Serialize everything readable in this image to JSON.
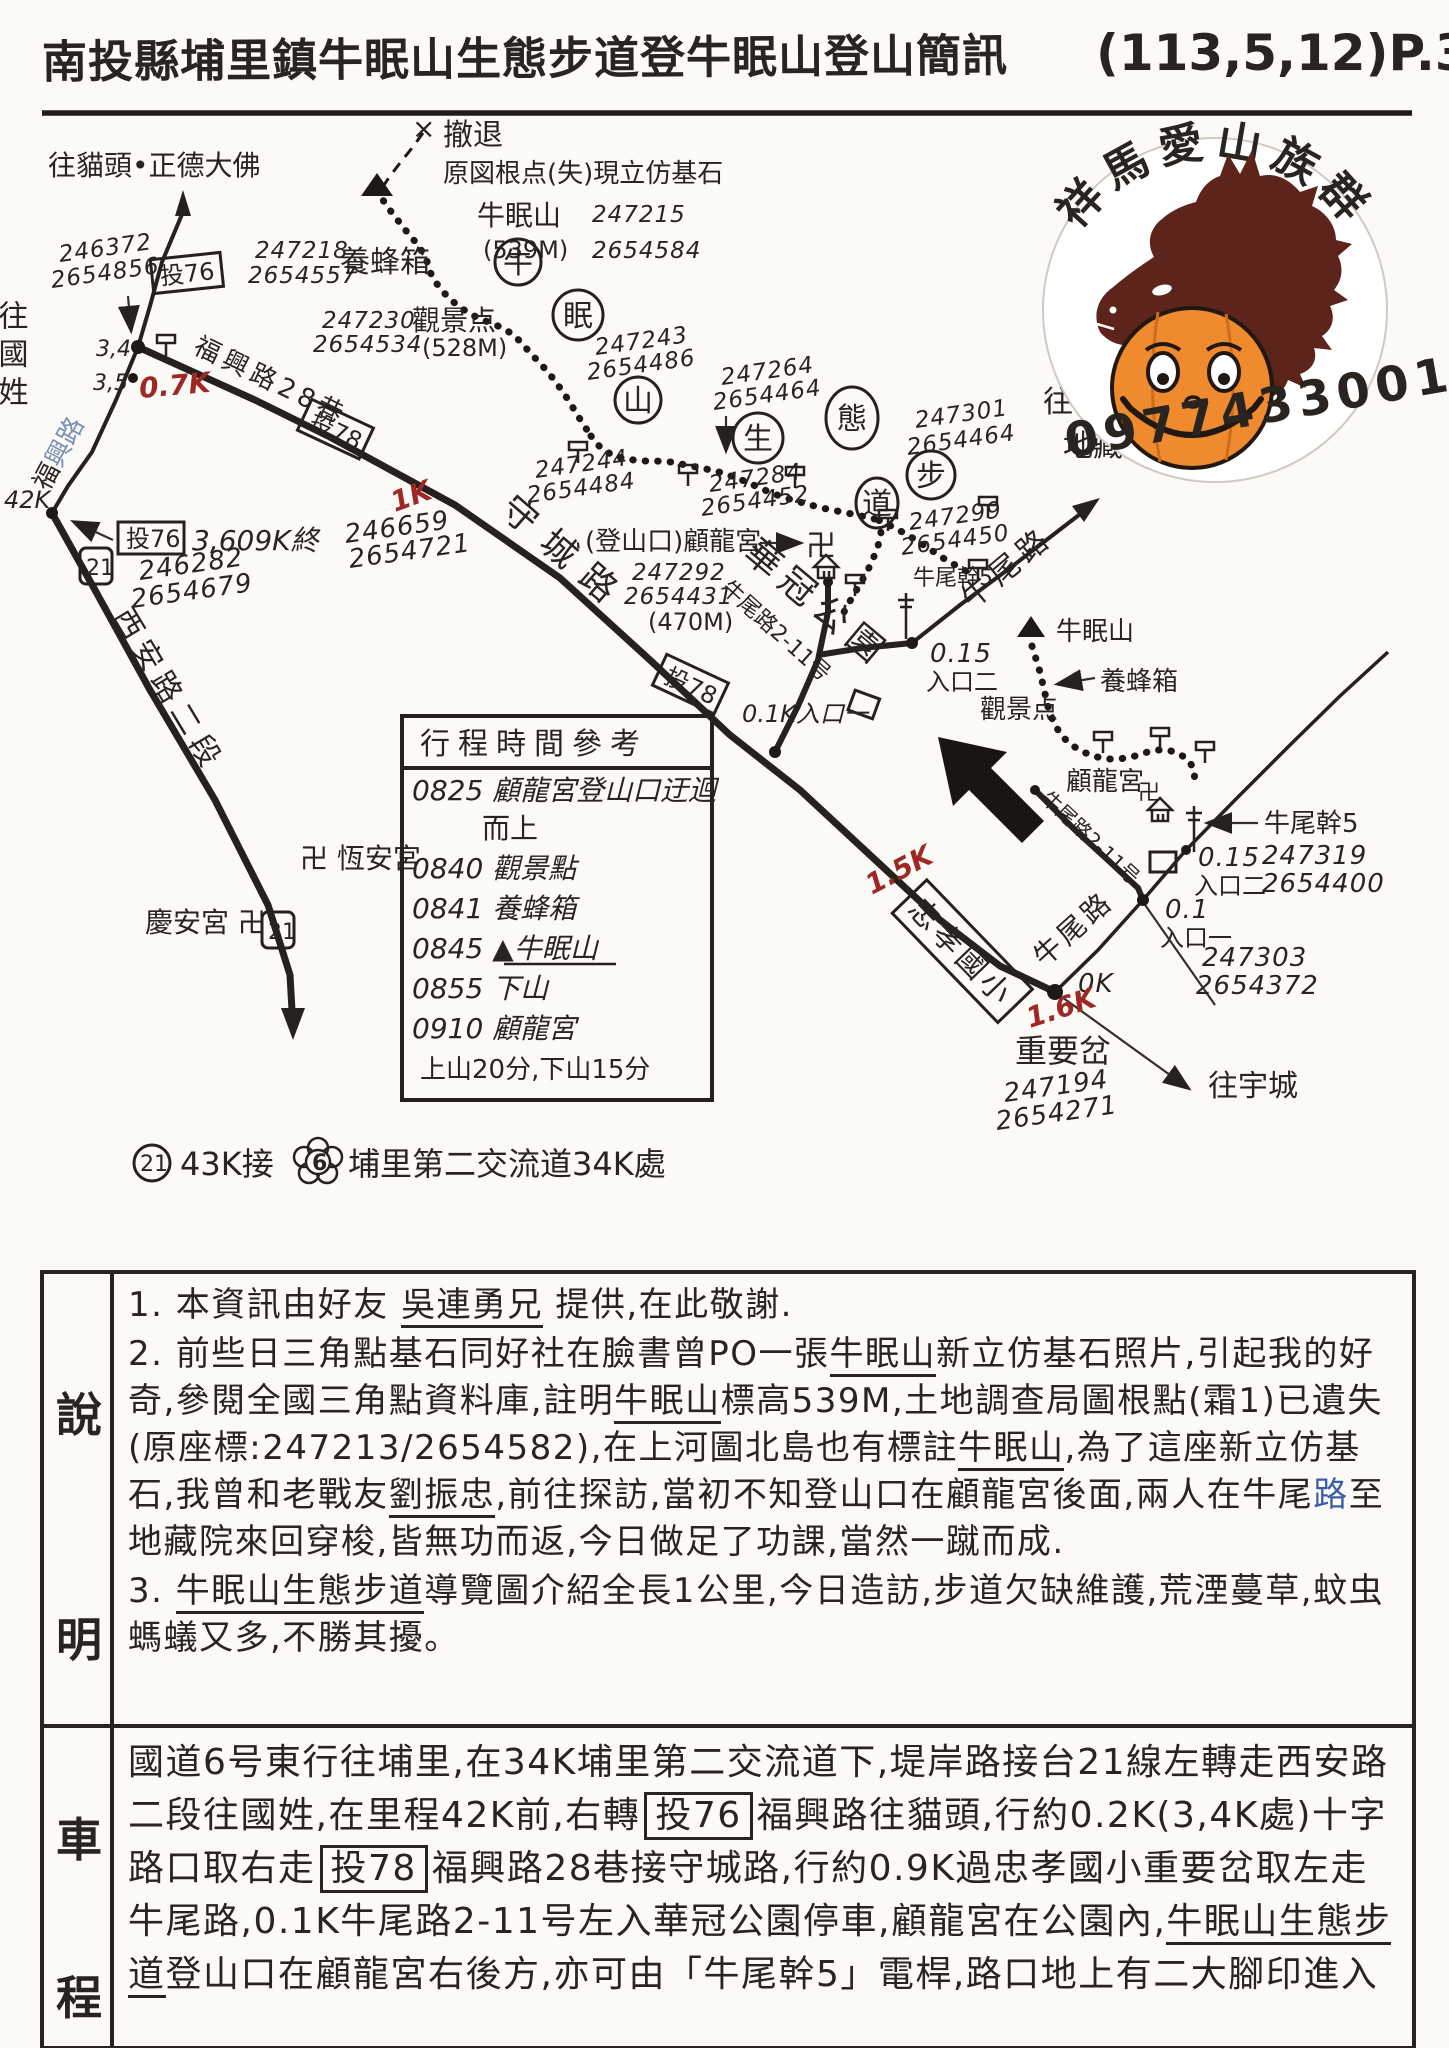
{
  "title": {
    "main": "南投縣埔里鎮牛眠山生態步道登牛眠山登山簡訊",
    "date": "(113,5,12)",
    "page": "P.38"
  },
  "logo": {
    "arc_text": "祥馬愛山族群",
    "phone": "0977433001",
    "horse_color": "#5c241a",
    "pumpkin_color": "#ef8a2e"
  },
  "map": {
    "l": {
      "to_maotou": "往貓頭•正德大佛",
      "c_a1": "246372",
      "c_a2": "2654856",
      "tou76": "投76",
      "tou78": "投78",
      "bee_c1": "247218",
      "bee_c2": "2654557",
      "beehive": "養蜂箱",
      "vp_c1": "247230",
      "vp_c2": "2654534",
      "viewpoint": "觀景点",
      "vp_elev": "(528M)",
      "retreat_x": "×",
      "retreat": "撤退",
      "origin_note": "原図根点(失)現立仿基石",
      "summit": "牛眠山",
      "summit_c1": "247215",
      "summit_elev": "(539M)",
      "summit_c2": "2654584",
      "t1": "牛",
      "t2": "眠",
      "t3": "山",
      "t4": "生",
      "t5": "態",
      "t6": "步",
      "t7": "道",
      "c243a": "247243",
      "c243b": "2654486",
      "c264a": "247264",
      "c264b": "2654464",
      "c301a": "247301",
      "c301b": "2654464",
      "c284a": "247284",
      "c284b": "2654452",
      "c299a": "247299",
      "c299b": "2654450",
      "c244a": "247244",
      "c244b": "2654484",
      "trailhead": "(登山口)顧龍宮",
      "swastika": "卍",
      "gulong": "顧龍宮",
      "gl_c1": "247292",
      "gl_c2": "2654431",
      "gl_elev": "(470M)",
      "huaguan": "華冠公園",
      "nwl211": "牛尾路2-11号",
      "nwg5": "牛尾幹5",
      "ent2_d": "0.15",
      "ent2": "入口二",
      "ent1k": "0.1K入口一",
      "ent1_d": "0.1",
      "ent1": "入口一",
      "fx28": "福興路28巷",
      "shouchenglu": "守城路",
      "fx_a": "福",
      "fx_b": "興路",
      "c659a": "246659",
      "c659b": "2654721",
      "k07": "0.7K",
      "k1": "1K",
      "k15": "1.5K",
      "k16": "1.6K",
      "k0": "0K",
      "k42": "42K",
      "j34": "3,4",
      "j35": "3,5",
      "to_guoxing": "往國姓",
      "tou76_end": "3,609K終",
      "c282a": "246282",
      "c282b": "2654679",
      "r21": "21",
      "r6": "6",
      "xian": "西安路二段",
      "hengan": "卍 恆安宮",
      "qingan": "慶安宮 卍",
      "n21_a": "43K接",
      "n21_b": "埔里第二交流道34K處",
      "to_nwz": "往牛尾庄",
      "dzy": "地藏院",
      "nwl": "牛尾路",
      "zhongxiao": "忠孝國小",
      "zycha": "重要岔",
      "c194a": "247194",
      "c194b": "2654271",
      "to_yucheng": "往宇城",
      "c319a": "247319",
      "c319b": "2654400",
      "c303a": "247303",
      "c303b": "2654372"
    },
    "table": {
      "title": "行程時間參考",
      "rows": [
        "0825 顧龍宮登山口迂迴",
        "而上",
        "0840 觀景點",
        "0841 養蜂箱",
        "0845 ▲牛眠山",
        "0855 下山",
        "0910 顧龍宮",
        "上山20分,下山15分"
      ]
    }
  },
  "notes": {
    "label1": "說",
    "label2": "明",
    "l1a": "1. 本資訊由好友 ",
    "l1b": "吳連勇兄",
    "l1c": " 提供,在此敬謝.",
    "l2a": "2. 前些日三角點基石同好社在臉書曾PO一張",
    "l2b": "牛眠山",
    "l2c": "新立仿基石照片,引起我的好奇,參閱全國三角點資料庫,註明",
    "l2d": "牛眠山",
    "l2e": "標高539M,土地調查局圖根點(霜1)已遺失(原座標:247213/2654582),在上河圖北島也有標註",
    "l2f": "牛眠山",
    "l2g": ",為了這座新立仿基石,我曾和老戰友",
    "l2h": "劉振忠",
    "l2i": ",前往探訪,當初不知登山口在顧龍宮後面,兩人在牛尾",
    "l2j": "路",
    "l2k": "至地藏院來回穿梭,皆無功而返,今日做足了功課,當然一蹴而成.",
    "l3a": "3. ",
    "l3b": "牛眠山生態步道",
    "l3c": "導覽圖介紹全長1公里,今日造訪,步道欠缺維護,荒湮蔓草,蚊虫螞蟻又多,不勝其擾。"
  },
  "route": {
    "label1": "車",
    "label2": "程",
    "r1": "國道6号東行往埔里,在34K埔里第二交流道下,堤岸路接台21線左轉走西安路二段往國姓,在里程42K前,右轉",
    "badge1": "投76",
    "r2": "福興路往貓頭,行約0.2K(3,4K處)十字路口取右走",
    "badge2": "投78",
    "r3": "福興路28巷接守城路,行約0.9K過忠孝國小重要岔取左走牛尾路,0.1K牛尾路2-11号左入華冠公園停車,顧龍宮在公園內,",
    "r4": "牛眠山生態步道",
    "r5": "登山口在顧龍宮右後方,亦可由「牛尾幹5」電桿,路口地上有二大腳印進入"
  }
}
